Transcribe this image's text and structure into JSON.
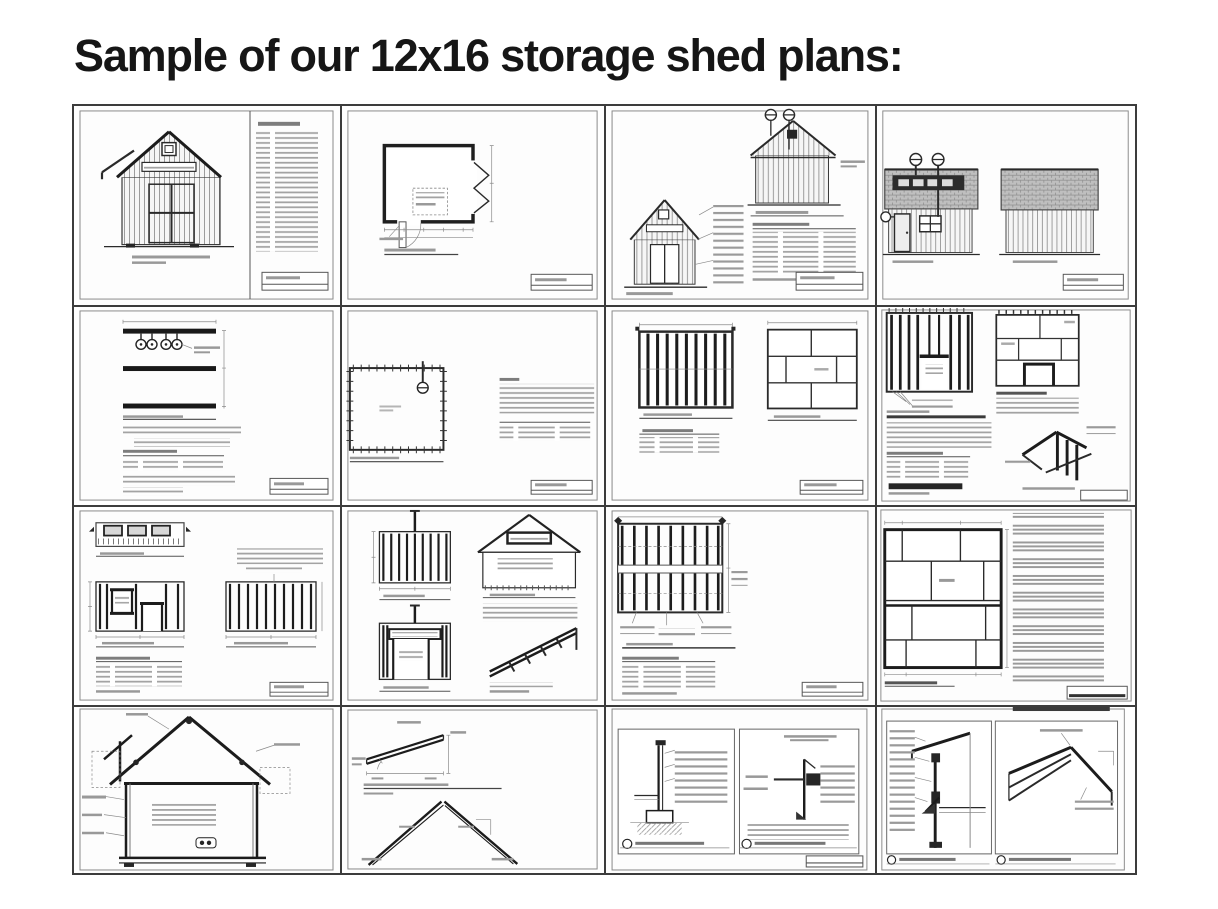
{
  "page": {
    "title": "Sample of our 12x16 storage shed plans:",
    "background_color": "#ffffff",
    "text_color": "#161616"
  },
  "grid": {
    "rows": 4,
    "columns": 4,
    "border_color": "#3c3c3c",
    "cells": [
      {
        "id": 1,
        "name": "cover-sheet",
        "content": "shed front elevation with drawing index list"
      },
      {
        "id": 2,
        "name": "floor-plan",
        "content": "floor plan with door swing, window symbols and dimensions"
      },
      {
        "id": 3,
        "name": "front-and-rear-elevations",
        "content": "front elevation with callouts, rear elevation with detail markers, materials list"
      },
      {
        "id": 4,
        "name": "side-elevations",
        "content": "left and right side elevations with shingled roofs"
      },
      {
        "id": 5,
        "name": "skid-foundation-plan",
        "content": "three skid runners with anchor markers and notes"
      },
      {
        "id": 6,
        "name": "floor-framing-plan",
        "content": "floor outline with joist tick marks, notes and materials table"
      },
      {
        "id": 7,
        "name": "floor-joist-and-sheeting-plan",
        "content": "joist layout and plywood floor sheeting layout"
      },
      {
        "id": 8,
        "name": "wall-framing-and-sheeting",
        "content": "front wall framing, wall sheeting layout, notes and isometric corner detail"
      },
      {
        "id": 9,
        "name": "side-wall-framing",
        "content": "header detail strip, window wall framing, stud wall framing and materials table"
      },
      {
        "id": 10,
        "name": "end-wall-and-gable-framing",
        "content": "rear wall framing, door wall framing, gable end framing and isometric detail"
      },
      {
        "id": 11,
        "name": "roof-framing-plan",
        "content": "rafter layout plan with callouts and materials table"
      },
      {
        "id": 12,
        "name": "roof-sheeting-plan",
        "content": "roof plywood panel layout with step-by-step instructions"
      },
      {
        "id": 13,
        "name": "building-cross-section",
        "content": "cross section through shed with roof truss and notes"
      },
      {
        "id": 14,
        "name": "rafter-details",
        "content": "rafter cut detail and assembled rafter pair detail"
      },
      {
        "id": 15,
        "name": "foundation-and-eave-details",
        "content": "concrete footing detail and eave trim detail"
      },
      {
        "id": 16,
        "name": "wall-section-and-ridge-details",
        "content": "wall section detail and ridge framing detail"
      }
    ]
  }
}
